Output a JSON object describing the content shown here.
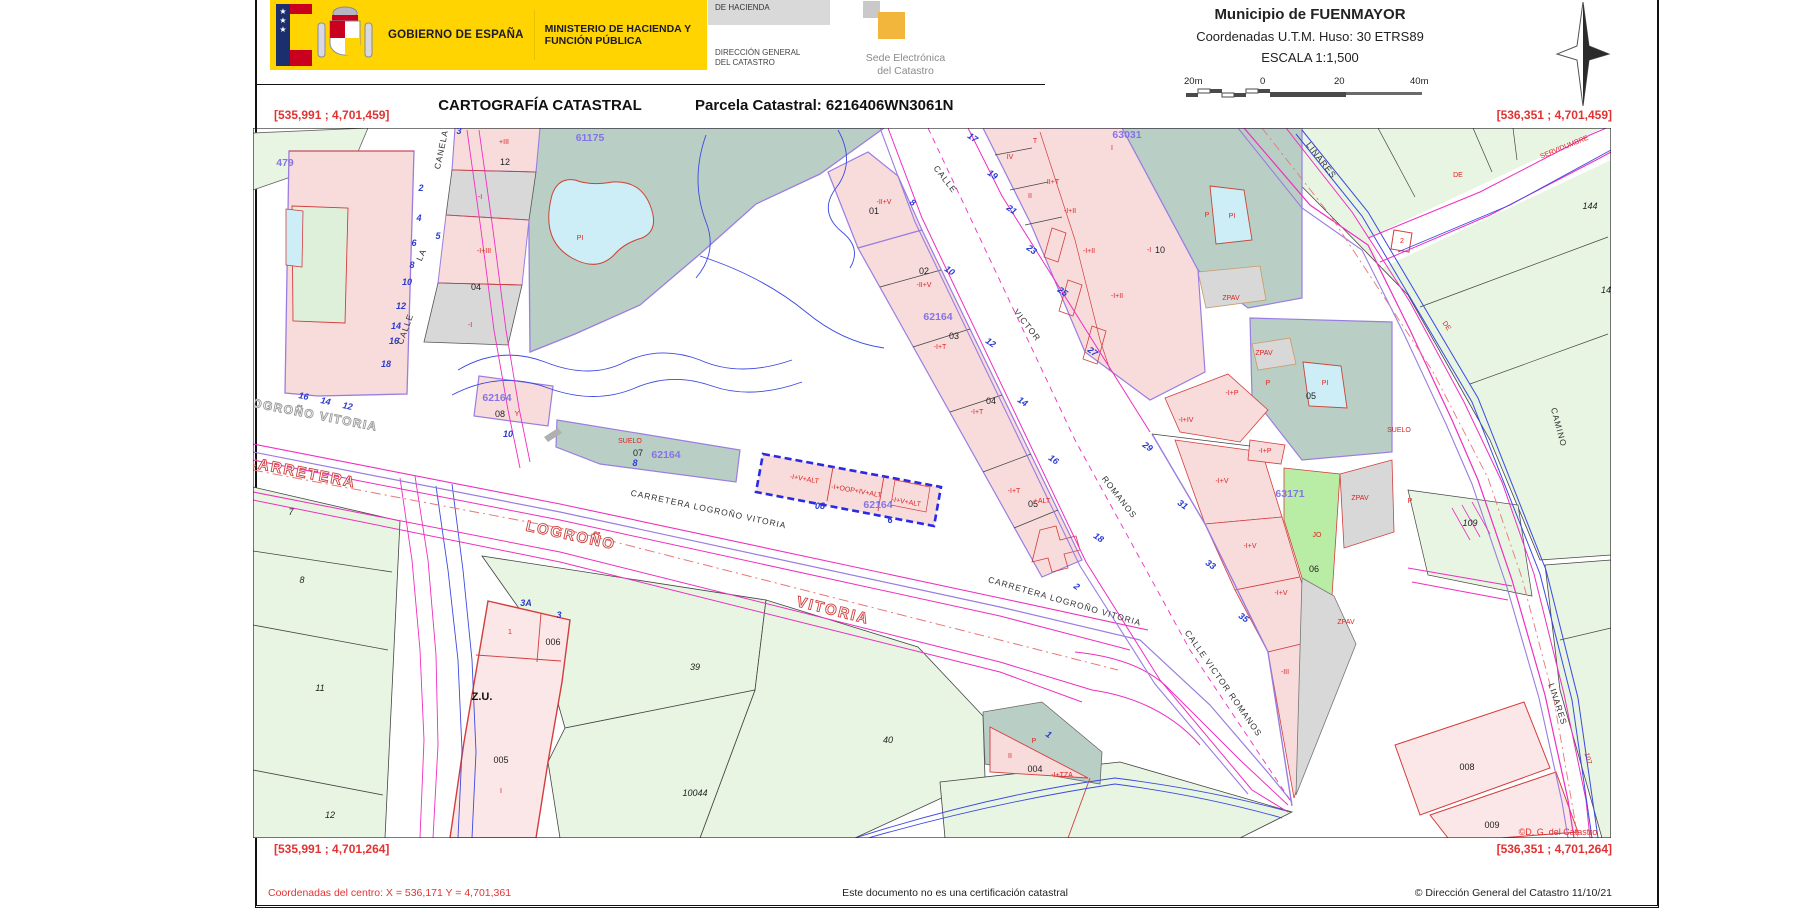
{
  "header": {
    "gobierno": "GOBIERNO DE ESPAÑA",
    "ministerio": "MINISTERIO DE HACIENDA Y FUNCIÓN PÚBLICA",
    "secretaria": "DE HACIENDA",
    "direccion_l1": "DIRECCIÓN GENERAL",
    "direccion_l2": "DEL CATASTRO",
    "sede_l1": "Sede Electrónica",
    "sede_l2": "del Catastro",
    "municipio": "Municipio de FUENMAYOR",
    "coordenadas": "Coordenadas U.T.M. Huso: 30 ETRS89",
    "escala": "ESCALA 1:1,500",
    "scalebar": {
      "left": "20m",
      "zero": "0",
      "mid": "20",
      "right": "40m"
    },
    "title": "CARTOGRAFÍA CATASTRAL",
    "parcela": "Parcela Catastral: 6216406WN3061N"
  },
  "corners": {
    "tl": "[535,991 ; 4,701,459]",
    "tr": "[536,351 ; 4,701,459]",
    "bl": "[535,991 ; 4,701,264]",
    "br": "[536,351 ; 4,701,264]"
  },
  "footer": {
    "centro": "Coordenadas del centro: X = 536,171 Y = 4,701,361",
    "aviso": "Este documento no es una certificación catastral",
    "copyright": "© Dirección General del Catastro 11/10/21"
  },
  "map": {
    "watermark": "©D. G. del Catastro",
    "labels": [
      [
        "479",
        285,
        166,
        0,
        "pnum"
      ],
      [
        "61175",
        590,
        141,
        0,
        "pnum"
      ],
      [
        "62164",
        497,
        401,
        0,
        "pnum"
      ],
      [
        "62164",
        666,
        458,
        0,
        "pnum"
      ],
      [
        "62164",
        938,
        320,
        0,
        "pnum"
      ],
      [
        "62164",
        878,
        508,
        0,
        "pnum"
      ],
      [
        "63031",
        1127,
        138,
        0,
        "pnum"
      ],
      [
        "63171",
        1290,
        497,
        0,
        "pnum"
      ],
      [
        "12",
        505,
        165,
        0,
        "num"
      ],
      [
        "04",
        476,
        290,
        0,
        "num"
      ],
      [
        "01",
        874,
        214,
        0,
        "num"
      ],
      [
        "02",
        924,
        274,
        0,
        "num"
      ],
      [
        "03",
        954,
        339,
        0,
        "num"
      ],
      [
        "04",
        991,
        404,
        0,
        "num"
      ],
      [
        "05",
        1033,
        507,
        0,
        "num"
      ],
      [
        "07",
        638,
        456,
        0,
        "num"
      ],
      [
        "08",
        500,
        417,
        0,
        "num"
      ],
      [
        "10",
        1160,
        253,
        0,
        "num"
      ],
      [
        "05",
        1311,
        399,
        0,
        "num"
      ],
      [
        "06",
        1314,
        572,
        0,
        "num"
      ],
      [
        "005",
        501,
        763,
        0,
        "num"
      ],
      [
        "006",
        553,
        645,
        0,
        "num"
      ],
      [
        "004",
        1035,
        772,
        0,
        "num"
      ],
      [
        "008",
        1467,
        770,
        0,
        "num"
      ],
      [
        "009",
        1492,
        828,
        0,
        "num"
      ],
      [
        "144",
        1590,
        209,
        0,
        "numi"
      ],
      [
        "14",
        1606,
        293,
        0,
        "numi"
      ],
      [
        "109",
        1470,
        526,
        0,
        "numi"
      ],
      [
        "39",
        695,
        670,
        0,
        "numi"
      ],
      [
        "40",
        888,
        743,
        0,
        "numi"
      ],
      [
        "10044",
        695,
        796,
        0,
        "numi"
      ],
      [
        "11",
        320,
        691,
        0,
        "numi"
      ],
      [
        "8",
        302,
        583,
        0,
        "numi"
      ],
      [
        "7",
        291,
        515,
        0,
        "numi"
      ],
      [
        "12",
        330,
        818,
        0,
        "numi"
      ],
      [
        "Z.U.",
        482,
        700,
        0,
        "zu"
      ],
      [
        "3",
        459,
        134,
        0,
        "addr"
      ],
      [
        "2",
        421,
        191,
        0,
        "addr"
      ],
      [
        "4",
        419,
        221,
        0,
        "addr"
      ],
      [
        "5",
        438,
        239,
        0,
        "addr"
      ],
      [
        "6",
        414,
        246,
        0,
        "addr"
      ],
      [
        "8",
        412,
        268,
        0,
        "addr"
      ],
      [
        "10",
        407,
        285,
        0,
        "addr"
      ],
      [
        "12",
        401,
        309,
        0,
        "addr"
      ],
      [
        "14",
        396,
        329,
        0,
        "addr"
      ],
      [
        "16",
        394,
        344,
        0,
        "addr"
      ],
      [
        "18",
        386,
        367,
        0,
        "addr"
      ],
      [
        "16",
        303,
        399,
        12,
        "addr"
      ],
      [
        "14",
        325,
        404,
        12,
        "addr"
      ],
      [
        "12",
        347,
        409,
        12,
        "addr"
      ],
      [
        "8",
        911,
        205,
        35,
        "addr"
      ],
      [
        "10",
        948,
        273,
        35,
        "addr"
      ],
      [
        "12",
        989,
        345,
        35,
        "addr"
      ],
      [
        "14",
        1021,
        404,
        35,
        "addr"
      ],
      [
        "16",
        1052,
        462,
        35,
        "addr"
      ],
      [
        "18",
        1097,
        540,
        35,
        "addr"
      ],
      [
        "2",
        1075,
        589,
        35,
        "addr"
      ],
      [
        "17",
        971,
        140,
        35,
        "addr"
      ],
      [
        "19",
        991,
        177,
        35,
        "addr"
      ],
      [
        "21",
        1010,
        212,
        35,
        "addr"
      ],
      [
        "23",
        1030,
        252,
        35,
        "addr"
      ],
      [
        "25",
        1061,
        294,
        35,
        "addr"
      ],
      [
        "27",
        1091,
        354,
        35,
        "addr"
      ],
      [
        "29",
        1146,
        449,
        35,
        "addr"
      ],
      [
        "31",
        1181,
        507,
        35,
        "addr"
      ],
      [
        "33",
        1209,
        567,
        35,
        "addr"
      ],
      [
        "35",
        1242,
        620,
        35,
        "addr"
      ],
      [
        "3A",
        526,
        606,
        0,
        "addr"
      ],
      [
        "3",
        559,
        618,
        0,
        "addr"
      ],
      [
        "10",
        508,
        437,
        0,
        "addr"
      ],
      [
        "8",
        635,
        466,
        0,
        "addr"
      ],
      [
        "08",
        820,
        509,
        0,
        "addr"
      ],
      [
        "6",
        890,
        523,
        0,
        "addr"
      ],
      [
        "1",
        1047,
        737,
        35,
        "addr"
      ],
      [
        "+III",
        504,
        144,
        0,
        "red"
      ],
      [
        "-I",
        480,
        199,
        0,
        "red"
      ],
      [
        "-I+III",
        484,
        253,
        0,
        "red"
      ],
      [
        "-I",
        470,
        327,
        0,
        "red"
      ],
      [
        "Y",
        517,
        416,
        0,
        "red"
      ],
      [
        "PI",
        580,
        240,
        0,
        "red"
      ],
      [
        "SUELO",
        630,
        443,
        0,
        "red"
      ],
      [
        "-II+V",
        884,
        204,
        0,
        "red"
      ],
      [
        "-II+V",
        924,
        287,
        0,
        "red"
      ],
      [
        "-I+T",
        940,
        349,
        0,
        "red"
      ],
      [
        "-I+T",
        977,
        414,
        0,
        "red"
      ],
      [
        "-I+T",
        1014,
        493,
        0,
        "red"
      ],
      [
        "+ALT",
        1042,
        503,
        0,
        "red"
      ],
      [
        "-I+V+ALT",
        804,
        481,
        10,
        "red"
      ],
      [
        "-I+OOP+IV+ALT",
        856,
        493,
        10,
        "red"
      ],
      [
        "-I+V+ALT",
        906,
        504,
        10,
        "red"
      ],
      [
        "T",
        1035,
        143,
        0,
        "red"
      ],
      [
        "IV",
        1010,
        159,
        0,
        "red"
      ],
      [
        "I",
        1112,
        150,
        0,
        "red"
      ],
      [
        "II+T",
        1053,
        184,
        0,
        "red"
      ],
      [
        "II",
        1030,
        198,
        0,
        "red"
      ],
      [
        "-I+II",
        1070,
        213,
        0,
        "red"
      ],
      [
        "-I+II",
        1089,
        253,
        0,
        "red"
      ],
      [
        "-I+II",
        1117,
        298,
        0,
        "red"
      ],
      [
        "-I",
        1149,
        252,
        0,
        "red"
      ],
      [
        "P",
        1207,
        217,
        0,
        "red"
      ],
      [
        "PI",
        1232,
        218,
        0,
        "red"
      ],
      [
        "ZPAV",
        1231,
        300,
        0,
        "red"
      ],
      [
        "ZPAV",
        1264,
        355,
        0,
        "red"
      ],
      [
        "DE",
        1458,
        177,
        0,
        "red"
      ],
      [
        "SERVIDUMBRE",
        1565,
        149,
        -22,
        "red"
      ],
      [
        "2",
        1402,
        243,
        0,
        "red"
      ],
      [
        "DE",
        1445,
        327,
        55,
        "red"
      ],
      [
        "-I+P",
        1232,
        395,
        0,
        "red"
      ],
      [
        "-I+IV",
        1186,
        422,
        0,
        "red"
      ],
      [
        "P",
        1268,
        385,
        0,
        "red"
      ],
      [
        "PI",
        1325,
        385,
        0,
        "red"
      ],
      [
        "SUELO",
        1399,
        432,
        0,
        "red"
      ],
      [
        "-I+P",
        1265,
        453,
        0,
        "red"
      ],
      [
        "-I+V",
        1222,
        483,
        0,
        "red"
      ],
      [
        "-I+V",
        1250,
        548,
        0,
        "red"
      ],
      [
        "-I+V",
        1281,
        595,
        0,
        "red"
      ],
      [
        "-III",
        1285,
        674,
        0,
        "red"
      ],
      [
        "JO",
        1317,
        537,
        0,
        "red"
      ],
      [
        "ZPAV",
        1360,
        500,
        0,
        "red"
      ],
      [
        "ZPAV",
        1346,
        624,
        0,
        "red"
      ],
      [
        "P",
        1410,
        503,
        0,
        "red"
      ],
      [
        "107",
        1586,
        759,
        75,
        "red"
      ],
      [
        "II",
        1010,
        758,
        0,
        "red"
      ],
      [
        "P",
        1034,
        743,
        0,
        "red"
      ],
      [
        "-I+TZA",
        1062,
        777,
        0,
        "red"
      ],
      [
        "1",
        510,
        634,
        0,
        "red"
      ],
      [
        "I",
        501,
        793,
        0,
        "red"
      ],
      [
        "CANELA",
        444,
        150,
        -78,
        "street"
      ],
      [
        "LA",
        424,
        256,
        -65,
        "street"
      ],
      [
        "CALLE",
        408,
        330,
        -70,
        "street"
      ],
      [
        "CALLE",
        943,
        181,
        52,
        "street"
      ],
      [
        "VICTOR",
        1025,
        327,
        52,
        "street"
      ],
      [
        "ROMANOS",
        1117,
        499,
        52,
        "street"
      ],
      [
        "CALLE VICTOR ROMANOS",
        1221,
        685,
        55,
        "street"
      ],
      [
        "LINARES",
        1319,
        162,
        52,
        "street"
      ],
      [
        "LINARES",
        1555,
        705,
        72,
        "street"
      ],
      [
        "CAMINO",
        1556,
        428,
        75,
        "street"
      ],
      [
        "CARRETERA LOGROÑO VITORIA",
        708,
        512,
        12,
        "street"
      ],
      [
        "CARRETERA LOGROÑO VITORIA",
        1064,
        604,
        16,
        "street"
      ],
      [
        "CARRETERA",
        300,
        477,
        11,
        "hollow"
      ],
      [
        "LOGROÑO",
        570,
        540,
        12,
        "hollow"
      ],
      [
        "VITORIA",
        832,
        615,
        14,
        "hollow"
      ],
      [
        "LOGROÑO VITORIA",
        310,
        418,
        11,
        "hgray"
      ],
      [
        "©D. G. del Catastro",
        1558,
        835,
        0,
        "wm"
      ]
    ]
  }
}
